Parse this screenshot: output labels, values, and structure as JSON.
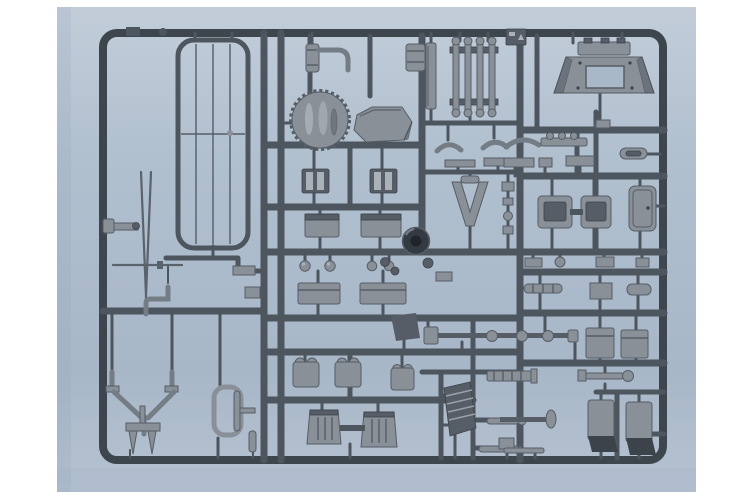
{
  "scene": {
    "title": "Plastic model kit sprue",
    "subject": "Product photo of a grey injection-molded model kit sprue (parts tree) on a pale blue backdrop",
    "background": "light blue photographic backdrop with white page margins",
    "material": "grey styrene plastic",
    "frame": "rectangular outer runner frame with internal rails dividing part compartments"
  },
  "colors": {
    "page_bg": "#ffffff",
    "photo_top": "#c2cdd9",
    "photo_upper": "#b1c0cf",
    "photo_lower": "#a8b7c8",
    "photo_bottom": "#b5c2d1",
    "runner_dark": "#3d454d",
    "runner_mid": "#4d555e",
    "part_fill": "#8a9098",
    "part_light": "#abb1b9",
    "part_dark": "#565d66",
    "part_darker": "#3c434b",
    "tube": "#747c85",
    "rod": "#5a626b",
    "wheel_dark": "#343a41",
    "wheel_hub": "#20252b",
    "hole_blue": "#a9b8c9",
    "shadow_blue": "#9fb0c3"
  },
  "parts": [
    {
      "id": "radiator-grille",
      "label": "Tall radiator grille panel with vertical slats"
    },
    {
      "id": "antenna-blade",
      "label": "Thin antenna rod with cross bar"
    },
    {
      "id": "elbow-pipe",
      "label": "L-shaped pipe"
    },
    {
      "id": "knob-bar",
      "label": "Short bar with end block"
    },
    {
      "id": "tow-bracket",
      "label": "Y-shaped towing bracket with feet"
    },
    {
      "id": "t-prong-bracket",
      "label": "T-bracket with two pointed prongs"
    },
    {
      "id": "frame-loop",
      "label": "Rounded loop frame with inner rod"
    },
    {
      "id": "exhaust-pipe",
      "label": "Cylinder with curved exhaust pipe"
    },
    {
      "id": "canister",
      "label": "Small banded cylinder"
    },
    {
      "id": "fan-drum",
      "label": "Round scallop-edged drum with ribs"
    },
    {
      "id": "hull-plate",
      "label": "Flat angular hull plate"
    },
    {
      "id": "clamp-bracket-left",
      "label": "Small clamp bracket"
    },
    {
      "id": "clamp-bracket-right",
      "label": "Small clamp bracket"
    },
    {
      "id": "stowage-box-left",
      "label": "Stowage box"
    },
    {
      "id": "stowage-box-right",
      "label": "Stowage box"
    },
    {
      "id": "lamp-knobs",
      "label": "Four round lamp knobs"
    },
    {
      "id": "tool-box-left",
      "label": "Lidded tool box"
    },
    {
      "id": "tool-box-right",
      "label": "Lidded tool box"
    },
    {
      "id": "dark-wedge",
      "label": "Angular wedge plate"
    },
    {
      "id": "crew-seat-1",
      "label": "Crew seat back"
    },
    {
      "id": "crew-seat-2",
      "label": "Crew seat back"
    },
    {
      "id": "crew-seat-3",
      "label": "Crew seat back"
    },
    {
      "id": "seat-cushion-left",
      "label": "Large grooved seat cushion"
    },
    {
      "id": "seat-cushion-right",
      "label": "Large grooved seat cushion"
    },
    {
      "id": "side-strip",
      "label": "Flat vertical strip"
    },
    {
      "id": "leaf-springs",
      "label": "Leaf-spring ladder frame with round ends"
    },
    {
      "id": "arc-brackets",
      "label": "Two arched brackets"
    },
    {
      "id": "flat-bars",
      "label": "Two flat bars"
    },
    {
      "id": "suspension-wishbone",
      "label": "V-shaped suspension arm"
    },
    {
      "id": "fitting-chain",
      "label": "Column of small fittings"
    },
    {
      "id": "road-wheel",
      "label": "Dark rimmed road wheel"
    },
    {
      "id": "drive-shaft",
      "label": "Long drive shaft with couplings and flange"
    },
    {
      "id": "louver-panel",
      "label": "Louvered shutter panel"
    },
    {
      "id": "tool-rods",
      "label": "Three tool rods"
    },
    {
      "id": "finned-rod",
      "label": "Finned rod fitting"
    },
    {
      "id": "shaft-disc",
      "label": "Shaft with end disc"
    },
    {
      "id": "gun-mount-frame",
      "label": "Trapezoid mount frame with rectangular opening"
    },
    {
      "id": "marking-tab",
      "label": "Embossed identification tab"
    },
    {
      "id": "handle-bar",
      "label": "Bar with three bumps"
    },
    {
      "id": "arc-handle",
      "label": "Curved handle"
    },
    {
      "id": "pill-fitting",
      "label": "Oval pill fitting"
    },
    {
      "id": "small-bars",
      "label": "Assorted small bars"
    },
    {
      "id": "bench-seat-left",
      "label": "Bench seat shell"
    },
    {
      "id": "bench-seat-right",
      "label": "Bench seat shell"
    },
    {
      "id": "door-panel",
      "label": "Rounded door panel with handle"
    },
    {
      "id": "cylinder-rack",
      "label": "Rack of small cylinders"
    },
    {
      "id": "crate-box",
      "label": "Small crate"
    },
    {
      "id": "oval-fitting",
      "label": "Oval fitting"
    },
    {
      "id": "stowage-bin-left",
      "label": "Stowage bin"
    },
    {
      "id": "stowage-bin-right",
      "label": "Stowage bin"
    },
    {
      "id": "wrench-tool",
      "label": "Wrench-like tool"
    },
    {
      "id": "fuel-tank-left",
      "label": "Tall tank with dark base"
    },
    {
      "id": "fuel-tank-right",
      "label": "Tall tank with dark base"
    },
    {
      "id": "small-fittings",
      "label": "Assorted knobs, stubs and fittings"
    }
  ]
}
